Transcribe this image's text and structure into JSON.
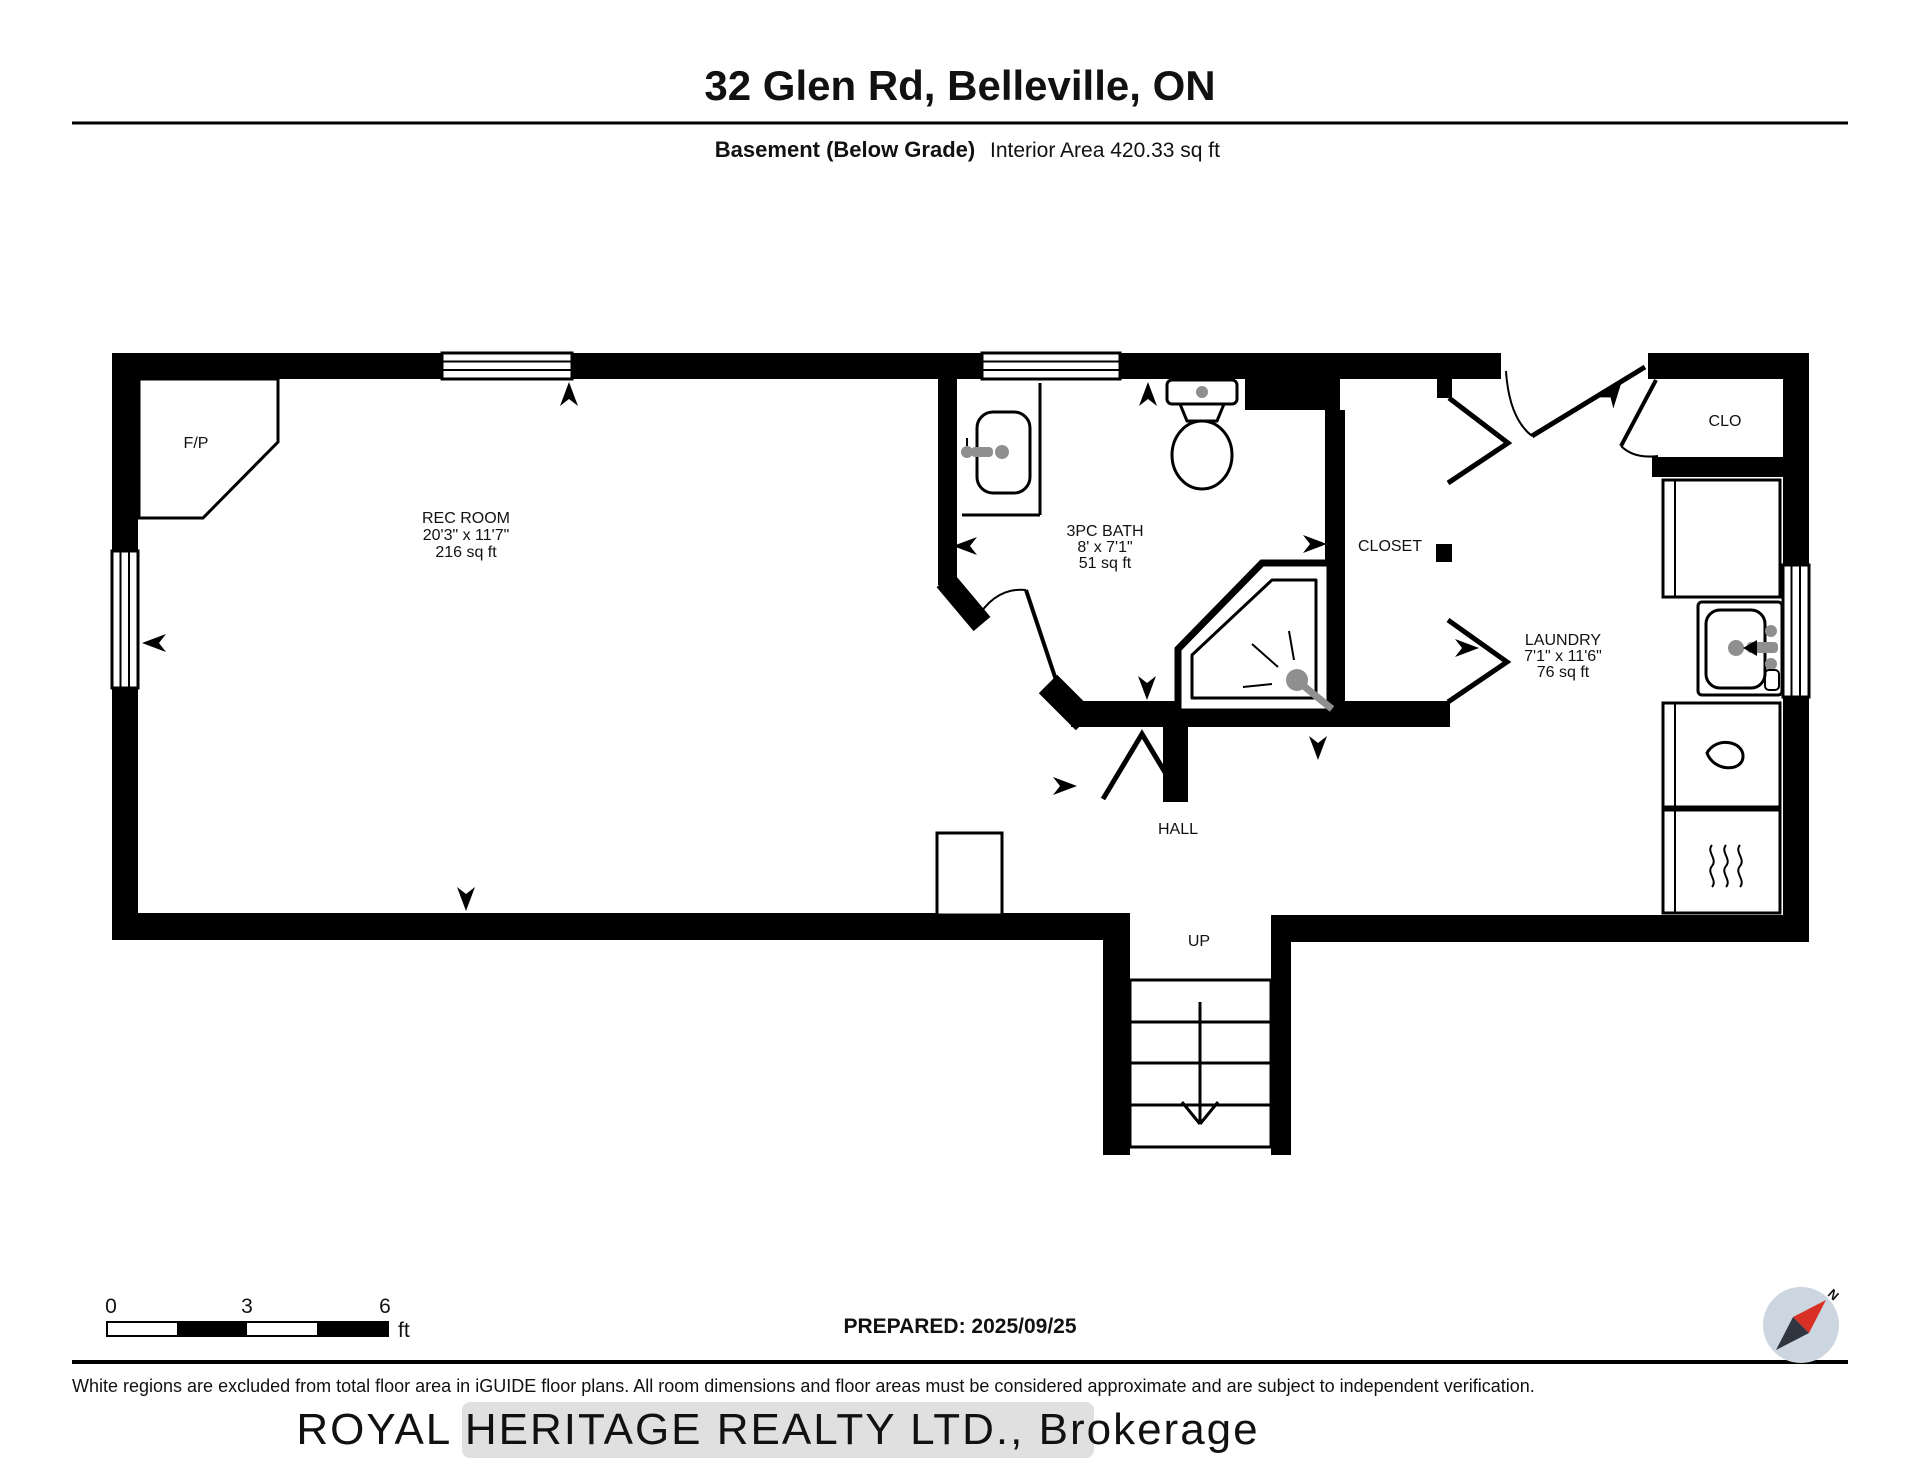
{
  "page": {
    "title": "32 Glen Rd, Belleville, ON",
    "floor_label": "Basement (Below Grade)",
    "area_label": "Interior Area 420.33 sq ft"
  },
  "rooms": {
    "fireplace": {
      "name": "F/P"
    },
    "rec_room": {
      "name": "REC ROOM",
      "dims": "20'3\" x 11'7\"",
      "area": "216 sq ft"
    },
    "bath": {
      "name": "3PC BATH",
      "dims": "8' x 7'1\"",
      "area": "51 sq ft"
    },
    "closet": {
      "name": "CLOSET"
    },
    "laundry": {
      "name": "LAUNDRY",
      "dims": "7'1\" x 11'6\"",
      "area": "76 sq ft"
    },
    "clo": {
      "name": "CLO"
    },
    "hall": {
      "name": "HALL"
    },
    "stairs": {
      "name": "UP"
    }
  },
  "scale_bar": {
    "start": "0",
    "mid": "3",
    "end": "6",
    "unit": "ft"
  },
  "footer": {
    "prepared": "PREPARED: 2025/09/25",
    "disclaimer": "White regions are excluded from total floor area in iGUIDE floor plans. All room dimensions and floor areas must be considered approximate and are subject to independent verification.",
    "watermark": "ROYAL HERITAGE REALTY LTD., Brokerage"
  },
  "compass": {
    "north_label": "N"
  },
  "colors": {
    "wall": "#000000",
    "fixture_gray": "#8f8f8f",
    "compass_disc": "#ccd6e0",
    "compass_north": "#d93025",
    "compass_south": "#2f3640",
    "watermark_band": "#e0e0e0",
    "watermark_text": "#f7f7f7"
  }
}
